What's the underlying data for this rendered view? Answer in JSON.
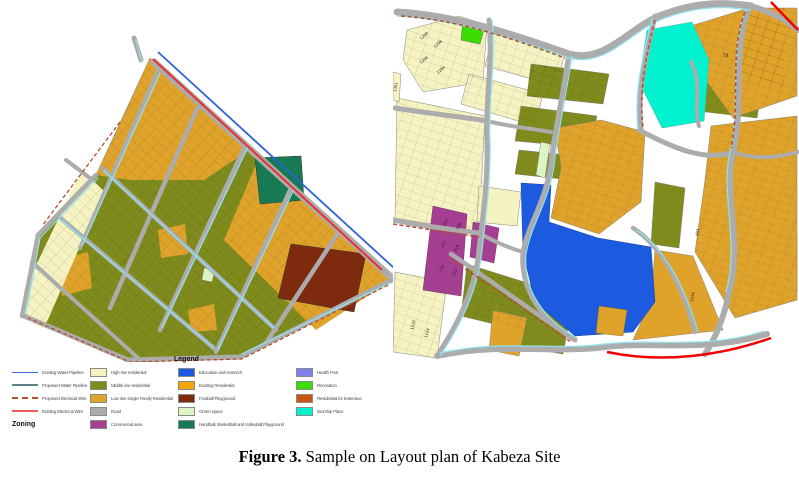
{
  "figure": {
    "caption_label": "Figure 3.",
    "caption_text": " Sample on Layout plan of Kabeza Site"
  },
  "legend": {
    "title": "Legend",
    "zoning_heading": "Zoning",
    "line_items": [
      {
        "label": "Existing Water Pipeline",
        "color": "#3A6FD8",
        "style": "solid"
      },
      {
        "label": "Proposed Water Pipeline",
        "color": "#5E8289",
        "style": "solid"
      },
      {
        "label": "Proposed Electrical Wire",
        "color": "#B5502F",
        "style": "dashed"
      },
      {
        "label": "Existing Electrical Wire",
        "color": "#F05B5B",
        "style": "solid"
      }
    ],
    "zone_items_col2": [
      {
        "label": "High rise residential",
        "color": "#F6F3C3"
      },
      {
        "label": "Middle rise residential",
        "color": "#7F8B1D"
      },
      {
        "label": "Low rise Single Family Residential",
        "color": "#DCA62A"
      },
      {
        "label": "Road",
        "color": "#ACACAC"
      },
      {
        "label": "Commercial area",
        "color": "#A53F92"
      }
    ],
    "zone_items_col3": [
      {
        "label": "Education and research",
        "color": "#1C5BDF"
      },
      {
        "label": "Existing Residential",
        "color": "#F4A701"
      },
      {
        "label": "Football Playground",
        "color": "#7D2A0F"
      },
      {
        "label": "Green space",
        "color": "#DDF5C4"
      },
      {
        "label": "Handball, Basketball and Volleyball Playground",
        "color": "#177A53"
      }
    ],
    "zone_items_col4": [
      {
        "label": "Health Post",
        "color": "#8080EF"
      },
      {
        "label": "Recreation",
        "color": "#3BDE00"
      },
      {
        "label": "Residential for Extension",
        "color": "#C75512"
      },
      {
        "label": "Worship Place",
        "color": "#00F2CE"
      }
    ]
  },
  "maps": {
    "right": {
      "parcel_labels": [
        "227",
        "228",
        "217",
        "218",
        "214",
        "213",
        "74",
        "1299",
        "1298",
        "1296",
        "1294",
        "1301",
        "1219",
        "1224",
        "403",
        "1074"
      ]
    }
  }
}
